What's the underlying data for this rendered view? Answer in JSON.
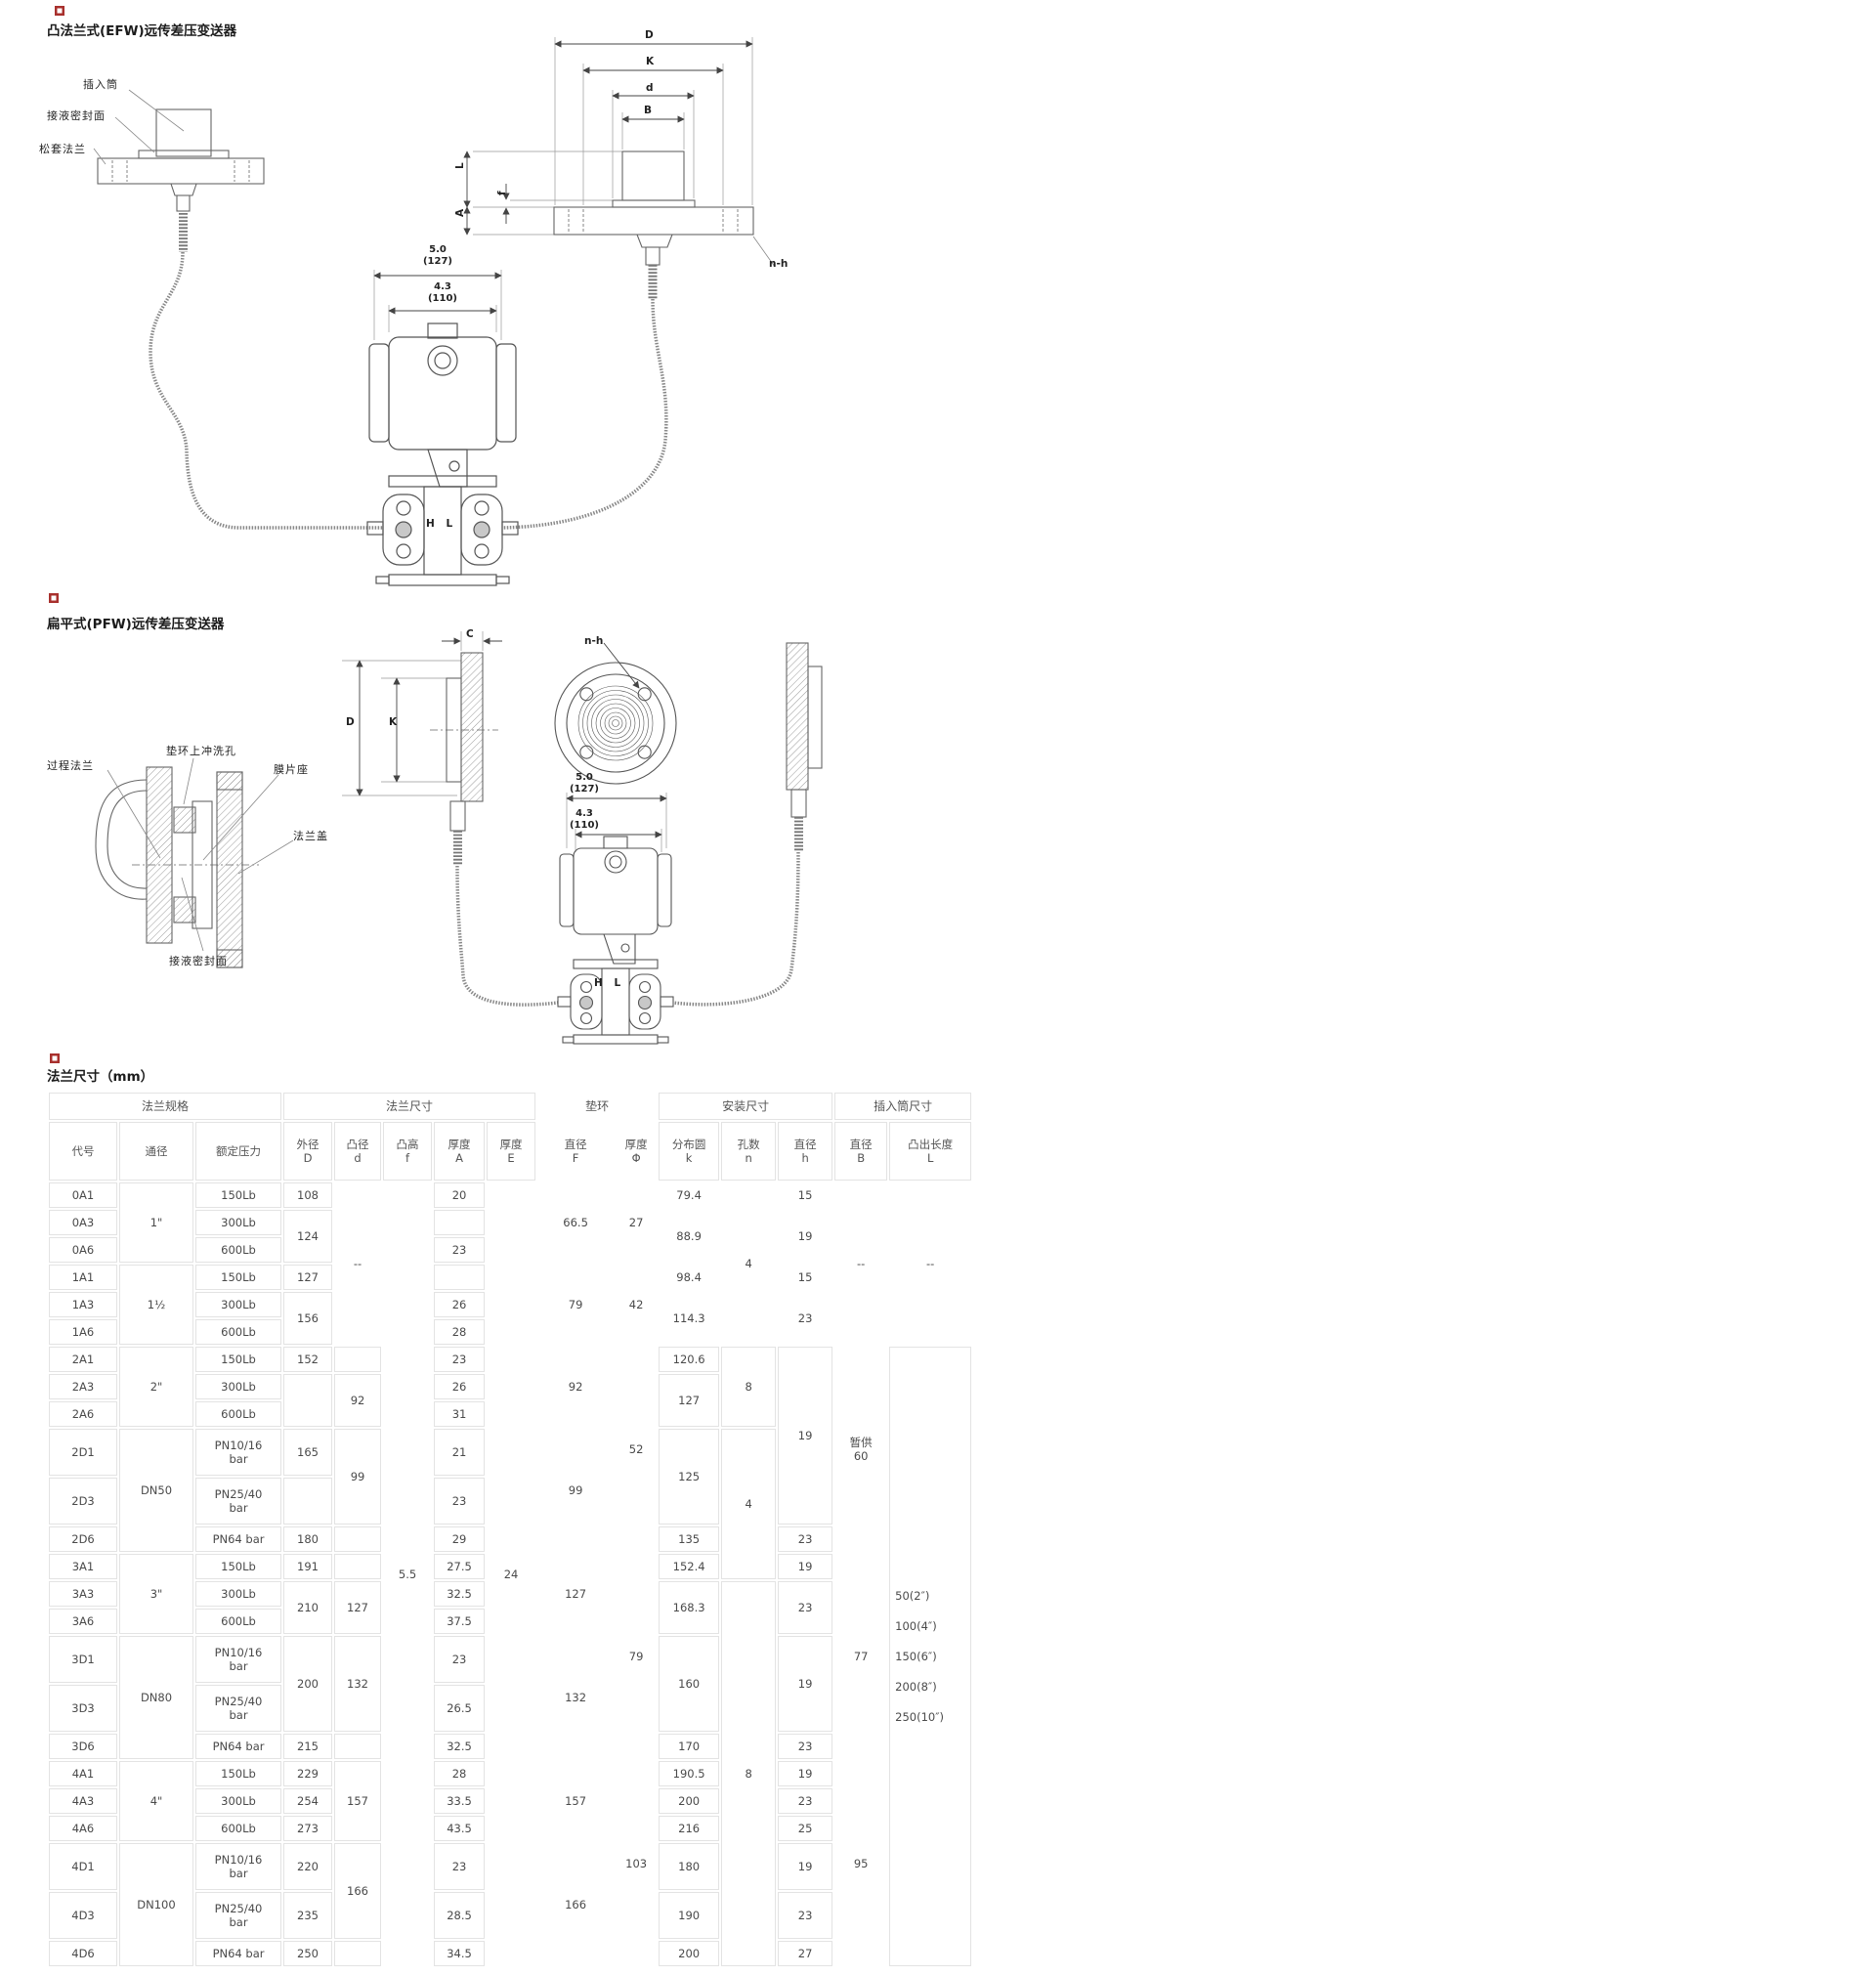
{
  "diagram_efw": {
    "title": "凸法兰式(EFW)远传差压变送器",
    "callouts": {
      "insert_tube": "插入筒",
      "wetted_seal_face": "接液密封面",
      "loose_flange": "松套法兰"
    },
    "dims": {
      "D": "D",
      "K": "K",
      "d": "d",
      "B": "B",
      "L": "L",
      "A": "A",
      "f": "f",
      "n_h": "n-h",
      "width_in": "5.0",
      "width_mm": "(127)",
      "width2_in": "4.3",
      "width2_mm": "(110)",
      "hl": "H L"
    }
  },
  "diagram_pfw": {
    "title": "扁平式(PFW)远传差压变送器",
    "callouts": {
      "process_flange": "过程法兰",
      "flush_hole": "垫环上冲洗孔",
      "diaphragm_seat": "膜片座",
      "flange_cover": "法兰盖",
      "wetted_seal_face": "接液密封面"
    },
    "dims": {
      "C": "C",
      "D": "D",
      "K": "K",
      "n_h": "n-h",
      "width_in": "5.0",
      "width_mm": "(127)",
      "width2_in": "4.3",
      "width2_mm": "(110)",
      "hl": "H L"
    }
  },
  "table": {
    "title": "法兰尺寸（mm）",
    "header": {
      "groups": [
        {
          "t": "法兰规格",
          "cs": 3
        },
        {
          "t": "法兰尺寸",
          "cs": 5
        },
        {
          "t": "垫环",
          "cs": 2,
          "nb": true
        },
        {
          "t": "安装尺寸",
          "cs": 3
        },
        {
          "t": "插入筒尺寸",
          "cs": 2
        }
      ],
      "columns": [
        {
          "t": "代号"
        },
        {
          "t": "通径"
        },
        {
          "t": "额定压力"
        },
        {
          "lines": [
            "外径",
            "D"
          ]
        },
        {
          "lines": [
            "凸径",
            "d"
          ]
        },
        {
          "lines": [
            "凸高",
            "f"
          ]
        },
        {
          "lines": [
            "厚度",
            "A"
          ]
        },
        {
          "lines": [
            "厚度",
            "E"
          ]
        },
        {
          "lines": [
            "直径",
            "F"
          ],
          "nb": true
        },
        {
          "lines": [
            "厚度",
            "Φ"
          ],
          "nb": true
        },
        {
          "lines": [
            "分布圆",
            "k"
          ]
        },
        {
          "lines": [
            "孔数",
            "n"
          ]
        },
        {
          "lines": [
            "直径",
            "h"
          ]
        },
        {
          "lines": [
            "直径",
            "B"
          ]
        },
        {
          "lines": [
            "凸出长度",
            "L"
          ]
        }
      ]
    },
    "rows": [
      {
        "cells": [
          {
            "t": "0A1"
          },
          {
            "t": "1\"",
            "rs": 3
          },
          {
            "t": "150Lb"
          },
          {
            "t": "108"
          },
          {
            "t": "--",
            "rs": 6,
            "nb": true
          },
          {
            "t": "5.5",
            "rs": 24,
            "nb": true
          },
          {
            "t": "20"
          },
          {
            "t": "24",
            "rs": 24,
            "nb": true
          },
          {
            "t": "66.5",
            "rs": 3,
            "nb": true
          },
          {
            "t": "27",
            "rs": 3,
            "nb": true
          },
          {
            "t": "79.4",
            "nb": true
          },
          {
            "t": "4",
            "rs": 6,
            "nb": true
          },
          {
            "t": "15",
            "nb": true
          },
          {
            "t": "--",
            "rs": 6,
            "nb": true
          },
          {
            "t": "--",
            "rs": 6,
            "nb": true
          }
        ]
      },
      {
        "cells": [
          {
            "t": "0A3"
          },
          {
            "t": "300Lb"
          },
          {
            "t": "124",
            "rs": 2
          },
          {
            "t": ""
          },
          {
            "t": "88.9",
            "rs": 2,
            "nb": true
          },
          {
            "t": "19",
            "rs": 2,
            "nb": true
          }
        ]
      },
      {
        "cells": [
          {
            "t": "0A6"
          },
          {
            "t": "600Lb"
          },
          {
            "t": "23"
          }
        ]
      },
      {
        "cells": [
          {
            "t": "1A1"
          },
          {
            "t": "1½",
            "rs": 3
          },
          {
            "t": "150Lb"
          },
          {
            "t": "127"
          },
          {
            "t": ""
          },
          {
            "t": "79",
            "rs": 3,
            "nb": true
          },
          {
            "t": "42",
            "rs": 3,
            "nb": true
          },
          {
            "t": "98.4",
            "nb": true
          },
          {
            "t": "15",
            "nb": true
          }
        ]
      },
      {
        "cells": [
          {
            "t": "1A3"
          },
          {
            "t": "300Lb"
          },
          {
            "t": "156",
            "rs": 2
          },
          {
            "t": "26"
          },
          {
            "t": "114.3",
            "rs": 2,
            "nb": true
          },
          {
            "t": "23",
            "rs": 2,
            "nb": true
          }
        ]
      },
      {
        "cells": [
          {
            "t": "1A6"
          },
          {
            "t": "600Lb"
          },
          {
            "t": "28"
          }
        ]
      },
      {
        "cells": [
          {
            "t": "2A1"
          },
          {
            "t": "2\"",
            "rs": 3
          },
          {
            "t": "150Lb"
          },
          {
            "t": "152"
          },
          {
            "t": ""
          },
          {
            "t": "23"
          },
          {
            "t": "92",
            "rs": 3,
            "nb": true
          },
          {
            "t": "52",
            "rs": 6,
            "nb": true
          },
          {
            "t": "120.6"
          },
          {
            "t": "8",
            "rs": 3
          },
          {
            "t": "19",
            "rs": 5
          },
          {
            "lines": [
              "暂供",
              "60"
            ],
            "rs": 6,
            "nb": true
          },
          {
            "lines": [
              "50(2″)",
              "100(4″)",
              "150(6″)",
              "200(8″)",
              "250(10″)"
            ],
            "rs": 18,
            "list": true
          }
        ]
      },
      {
        "cells": [
          {
            "t": "2A3"
          },
          {
            "t": "300Lb"
          },
          {
            "t": "",
            "rs": 2
          },
          {
            "t": "92",
            "rs": 2
          },
          {
            "t": "26"
          },
          {
            "t": "127",
            "rs": 2
          }
        ]
      },
      {
        "cells": [
          {
            "t": "2A6"
          },
          {
            "t": "600Lb"
          },
          {
            "t": "31"
          }
        ]
      },
      {
        "h": 48,
        "cells": [
          {
            "t": "2D1"
          },
          {
            "t": "DN50",
            "rs": 3
          },
          {
            "lines": [
              "PN10/16",
              "bar"
            ]
          },
          {
            "t": "165"
          },
          {
            "t": "99",
            "rs": 2
          },
          {
            "t": "21"
          },
          {
            "t": "99",
            "rs": 3,
            "nb": true
          },
          {
            "t": "125",
            "rs": 2
          },
          {
            "t": "4",
            "rs": 4
          }
        ]
      },
      {
        "h": 48,
        "cells": [
          {
            "t": "2D3"
          },
          {
            "lines": [
              "PN25/40",
              "bar"
            ]
          },
          {
            "t": ""
          },
          {
            "t": "23"
          }
        ]
      },
      {
        "cells": [
          {
            "t": "2D6"
          },
          {
            "t": "PN64 bar"
          },
          {
            "t": "180"
          },
          {
            "t": ""
          },
          {
            "t": "29"
          },
          {
            "t": "135"
          },
          {
            "t": "23"
          }
        ]
      },
      {
        "cells": [
          {
            "t": "3A1"
          },
          {
            "t": "3\"",
            "rs": 3
          },
          {
            "t": "150Lb"
          },
          {
            "t": "191"
          },
          {
            "t": ""
          },
          {
            "t": "27.5"
          },
          {
            "t": "127",
            "rs": 3,
            "nb": true
          },
          {
            "t": "79",
            "rs": 6,
            "nb": true
          },
          {
            "t": "152.4"
          },
          {
            "t": "19"
          },
          {
            "t": "77",
            "rs": 6,
            "nb": true
          }
        ]
      },
      {
        "cells": [
          {
            "t": "3A3"
          },
          {
            "t": "300Lb"
          },
          {
            "t": "210",
            "rs": 2
          },
          {
            "t": "127",
            "rs": 2
          },
          {
            "t": "32.5"
          },
          {
            "t": "168.3",
            "rs": 2
          },
          {
            "t": "8",
            "rs": 11
          },
          {
            "t": "23",
            "rs": 2
          }
        ]
      },
      {
        "cells": [
          {
            "t": "3A6"
          },
          {
            "t": "600Lb"
          },
          {
            "t": "37.5"
          }
        ]
      },
      {
        "h": 48,
        "cells": [
          {
            "t": "3D1"
          },
          {
            "t": "DN80",
            "rs": 3
          },
          {
            "lines": [
              "PN10/16",
              "bar"
            ]
          },
          {
            "t": "200",
            "rs": 2
          },
          {
            "t": "132",
            "rs": 2
          },
          {
            "t": "23"
          },
          {
            "t": "132",
            "rs": 3,
            "nb": true
          },
          {
            "t": "160",
            "rs": 2
          },
          {
            "t": "19",
            "rs": 2
          }
        ]
      },
      {
        "h": 48,
        "cells": [
          {
            "t": "3D3"
          },
          {
            "lines": [
              "PN25/40",
              "bar"
            ]
          },
          {
            "t": "26.5"
          }
        ]
      },
      {
        "cells": [
          {
            "t": "3D6"
          },
          {
            "t": "PN64 bar"
          },
          {
            "t": "215"
          },
          {
            "t": ""
          },
          {
            "t": "32.5"
          },
          {
            "t": "170"
          },
          {
            "t": "23"
          }
        ]
      },
      {
        "cells": [
          {
            "t": "4A1"
          },
          {
            "t": "4\"",
            "rs": 3
          },
          {
            "t": "150Lb"
          },
          {
            "t": "229"
          },
          {
            "t": "157",
            "rs": 3
          },
          {
            "t": "28"
          },
          {
            "t": "157",
            "rs": 3,
            "nb": true
          },
          {
            "t": "103",
            "rs": 6,
            "nb": true
          },
          {
            "t": "190.5"
          },
          {
            "t": "19"
          },
          {
            "t": "95",
            "rs": 6,
            "nb": true
          }
        ]
      },
      {
        "cells": [
          {
            "t": "4A3"
          },
          {
            "t": "300Lb"
          },
          {
            "t": "254"
          },
          {
            "t": "33.5"
          },
          {
            "t": "200"
          },
          {
            "t": "23"
          }
        ]
      },
      {
        "cells": [
          {
            "t": "4A6"
          },
          {
            "t": "600Lb"
          },
          {
            "t": "273"
          },
          {
            "t": "43.5"
          },
          {
            "t": "216"
          },
          {
            "t": "25"
          }
        ]
      },
      {
        "h": 48,
        "cells": [
          {
            "t": "4D1"
          },
          {
            "t": "DN100",
            "rs": 3
          },
          {
            "lines": [
              "PN10/16",
              "bar"
            ]
          },
          {
            "t": "220"
          },
          {
            "t": "166",
            "rs": 2
          },
          {
            "t": "23"
          },
          {
            "t": "166",
            "rs": 3,
            "nb": true
          },
          {
            "t": "180"
          },
          {
            "t": "19"
          }
        ]
      },
      {
        "h": 48,
        "cells": [
          {
            "t": "4D3"
          },
          {
            "lines": [
              "PN25/40",
              "bar"
            ]
          },
          {
            "t": "235"
          },
          {
            "t": "28.5"
          },
          {
            "t": "190"
          },
          {
            "t": "23"
          }
        ]
      },
      {
        "cells": [
          {
            "t": "4D6"
          },
          {
            "t": "PN64 bar"
          },
          {
            "t": "250"
          },
          {
            "t": ""
          },
          {
            "t": "34.5"
          },
          {
            "t": "200"
          },
          {
            "t": "27"
          }
        ]
      }
    ]
  }
}
